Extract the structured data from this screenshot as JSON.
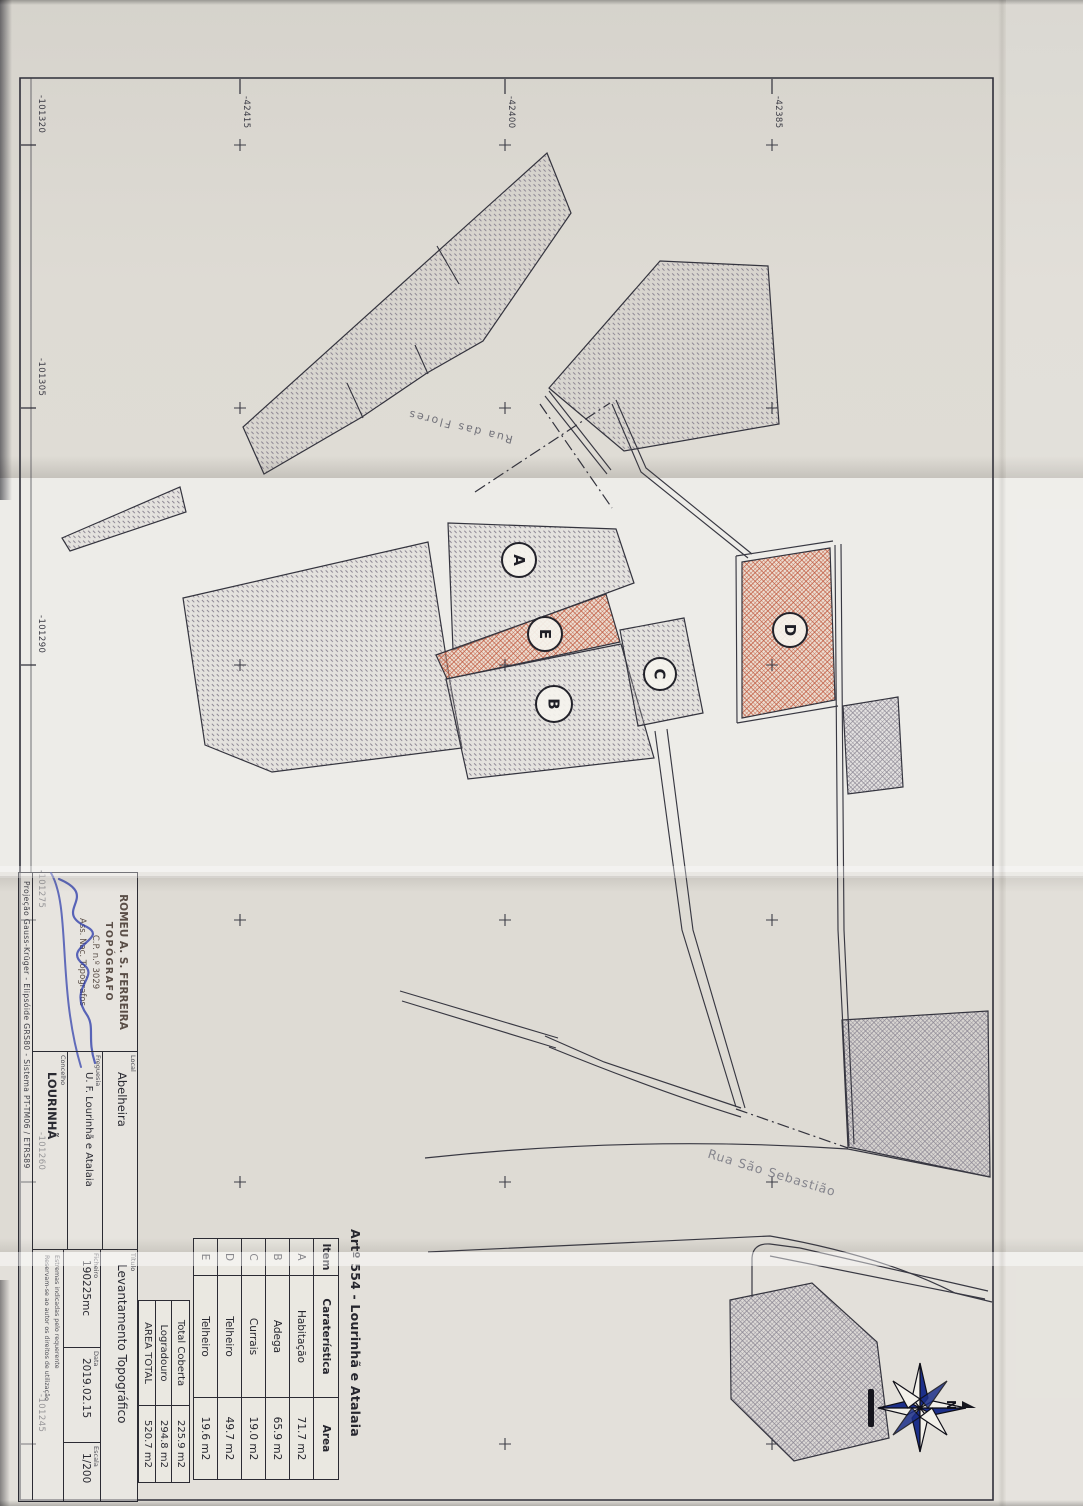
{
  "sheet": {
    "type_note": "Scanned cadastral / topographic survey plan, sheet rotated 90°"
  },
  "grid": {
    "top_labels": [
      "-42415",
      "-42400",
      "-42385"
    ],
    "left_labels": [
      "-101320",
      "-101305",
      "-101290",
      "-101275",
      "-101260",
      "-101245"
    ]
  },
  "streets": {
    "rua_das_flores": "Rua das Flores",
    "rua_sao_sebastiao": "Rua São Sebastião"
  },
  "parcels": [
    {
      "label": "A"
    },
    {
      "label": "B"
    },
    {
      "label": "C"
    },
    {
      "label": "D"
    },
    {
      "label": "E"
    }
  ],
  "legend_table": {
    "title": "Artº 554 - Lourinhã e Atalaia",
    "headers": [
      "Item",
      "Caraterística",
      "Area"
    ],
    "rows": [
      [
        "A",
        "Habitação",
        "71.7 m2"
      ],
      [
        "B",
        "Adega",
        "65.9 m2"
      ],
      [
        "C",
        "Currais",
        "19.0 m2"
      ],
      [
        "D",
        "Telheiro",
        "49.7 m2"
      ],
      [
        "E",
        "Telheiro",
        "19.6 m2"
      ]
    ],
    "totals": [
      [
        "Total Coberta",
        "225.9 m2"
      ],
      [
        "Logradouro",
        "294.8 m2"
      ],
      [
        "AREA TOTAL",
        "520.7 m2"
      ]
    ]
  },
  "title_block": {
    "stamp": {
      "lines": [
        "ROMEU A. S. FERREIRA",
        "TOPÓGRAFO",
        "C.P. n.º 3029",
        "Ass. Nac. Topógrafos"
      ]
    },
    "fields": [
      {
        "label": "Local",
        "value": "Abelheira"
      },
      {
        "label": "Freguesia",
        "value": "U. F. Lourinhã e Atalaia"
      },
      {
        "label": "Concelho",
        "value": "LOURINHÃ"
      }
    ],
    "doc": {
      "titulo_label": "Título",
      "titulo": "Levantamento Topográfico",
      "ficheiro_label": "Ficheiro",
      "ficheiro": "190225mc",
      "data_label": "Data",
      "data": "2019.02.15",
      "escala_label": "Escala",
      "escala": "1/200"
    },
    "notes": [
      "Estremas indicadas pelo requerente",
      "Reservam-se ao autor os direitos de utilização"
    ],
    "projection": "Projeção Gauss-Krüger - Elipsóide GRS80 - Sistema PT-TM06 / ETRS89"
  },
  "compass": {
    "north_label": "N"
  },
  "colors": {
    "ink": "#2b2b33",
    "hatch_gray": "#8e8894",
    "hatch_red": "#c05a40",
    "signature_blue": "#2838aa",
    "compass_navy": "#1c2f8a"
  }
}
